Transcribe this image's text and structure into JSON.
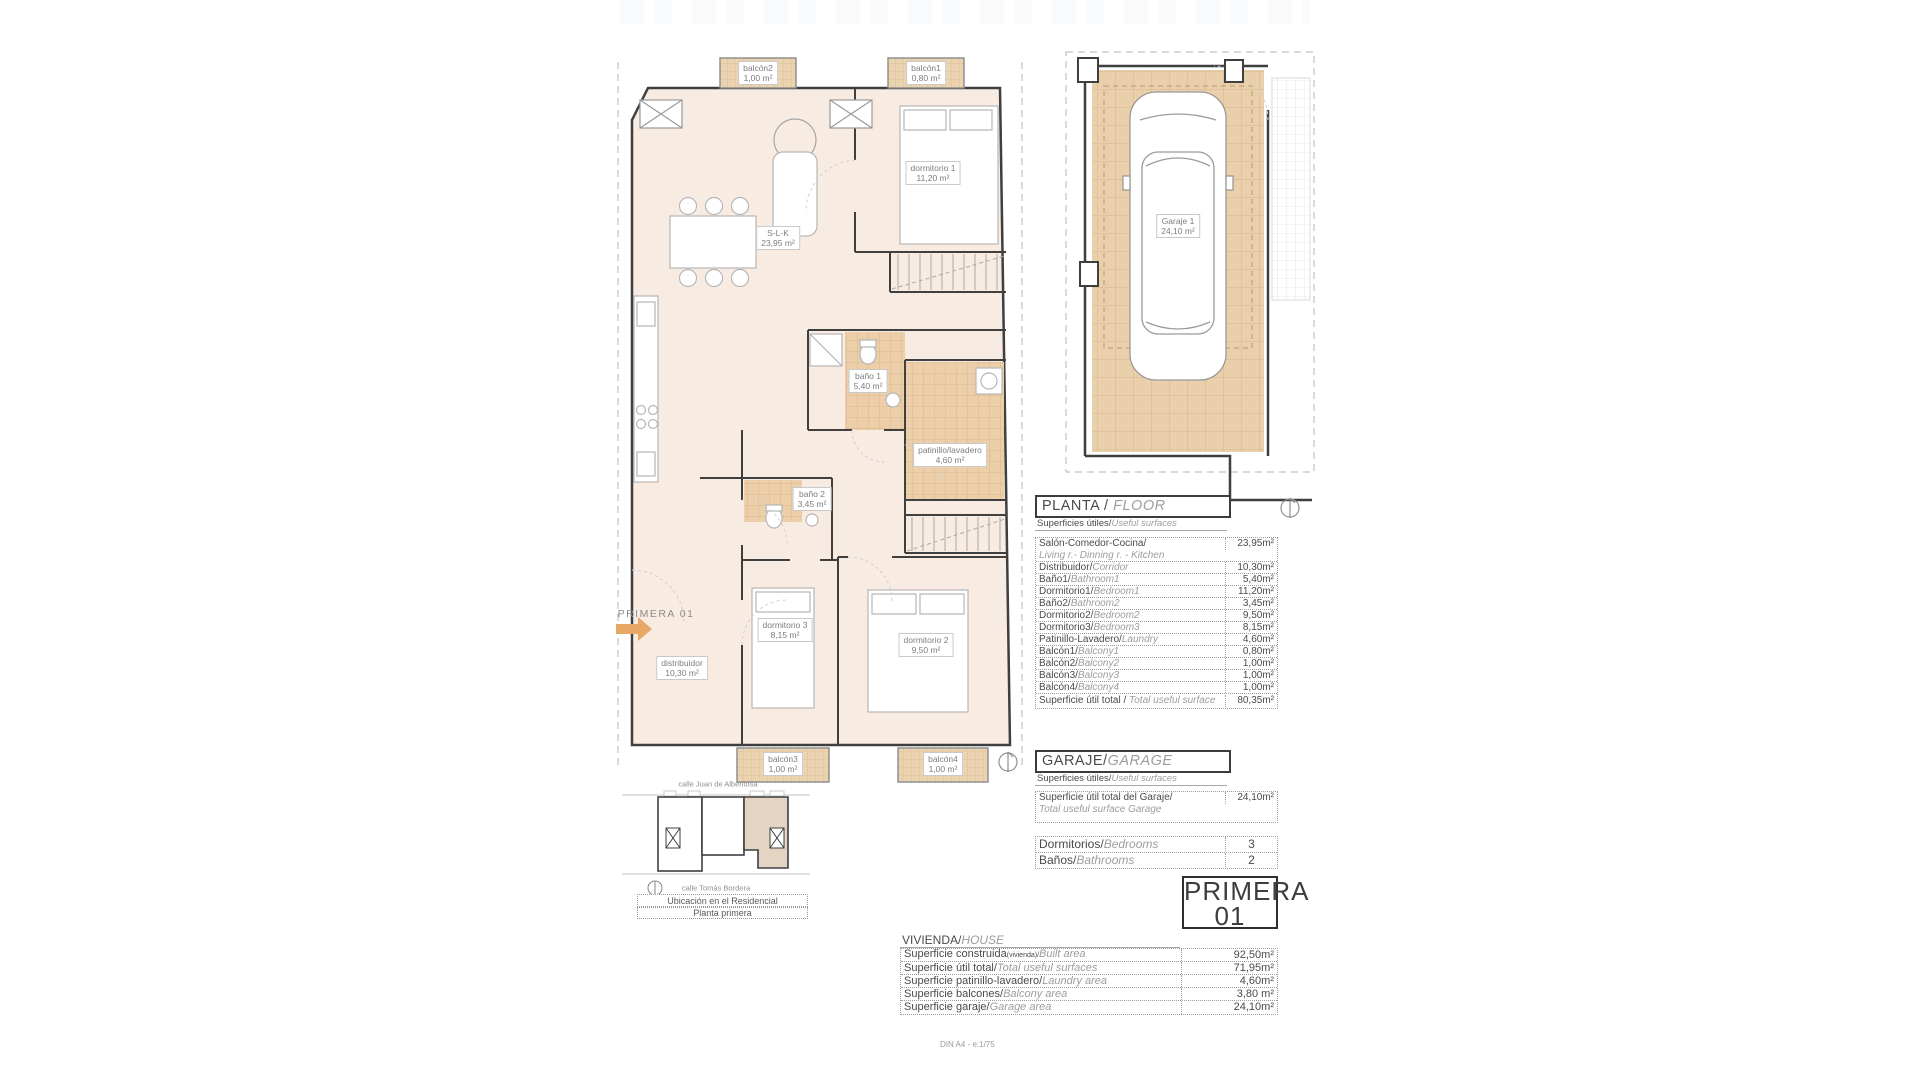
{
  "plan": {
    "unit_label": "PRIMERA 01",
    "labels": [
      {
        "name": "balcón2",
        "area": "1,00 m²"
      },
      {
        "name": "balcón1",
        "area": "0,80 m²"
      },
      {
        "name": "dormitorio 1",
        "area": "11,20 m²"
      },
      {
        "name": "S-L-K",
        "area": "23,95 m²"
      },
      {
        "name": "baño 1",
        "area": "5,40 m²"
      },
      {
        "name": "patinillo/lavadero",
        "area": "4,60 m²"
      },
      {
        "name": "baño 2",
        "area": "3,45 m²"
      },
      {
        "name": "dormitorio 3",
        "area": "8,15 m²"
      },
      {
        "name": "dormitorio 2",
        "area": "9,50 m²"
      },
      {
        "name": "distribuidor",
        "area": "10,30 m²"
      },
      {
        "name": "balcón3",
        "area": "1,00 m²"
      },
      {
        "name": "balcón4",
        "area": "1,00 m²"
      },
      {
        "name": "Garaje 1",
        "area": "24,10 m²"
      }
    ]
  },
  "planta": {
    "title_es": "PLANTA / ",
    "title_en": "FLOOR",
    "subtitle_es": "Superficies útiles/",
    "subtitle_en": "Useful surfaces",
    "rows": [
      {
        "es": "Salón-Comedor-Cocina/",
        "en": "Living r.- Dinning r. - Kitchen",
        "value": "23,95m²"
      },
      {
        "es": "Distribuidor/",
        "en": "Corridor",
        "value": "10,30m²"
      },
      {
        "es": "Baño1/",
        "en": "Bathroom1",
        "value": "5,40m²"
      },
      {
        "es": "Dormitorio1/",
        "en": "Bedroom1",
        "value": "11,20m²"
      },
      {
        "es": "Baño2/",
        "en": "Bathroom2",
        "value": "3,45m²"
      },
      {
        "es": "Dormitorio2/",
        "en": "Bedroom2",
        "value": "9,50m²"
      },
      {
        "es": "Dormitorio3/",
        "en": "Bedroom3",
        "value": "8,15m²"
      },
      {
        "es": "Patinillo-Lavadero/",
        "en": "Laundry",
        "value": "4,60m²"
      },
      {
        "es": "Balcón1/",
        "en": "Balcony1",
        "value": "0,80m²"
      },
      {
        "es": "Balcón2/",
        "en": "Balcony2",
        "value": "1,00m²"
      },
      {
        "es": "Balcón3/",
        "en": "Balcony3",
        "value": "1,00m²"
      },
      {
        "es": "Balcón4/",
        "en": "Balcony4",
        "value": "1,00m²"
      }
    ],
    "total_es": "Superficie útil total / ",
    "total_en": "Total useful surface",
    "total_value": "80,35m²"
  },
  "garaje": {
    "title_es": "GARAJE/",
    "title_en": "GARAGE",
    "subtitle_es": "Superficies útiles/",
    "subtitle_en": "Useful surfaces",
    "row_es": "Superficie útil total del Garaje/",
    "row_en": "Total useful surface Garage",
    "value": "24,10m²"
  },
  "counts": {
    "bedrooms_es": "Dormitorios/",
    "bedrooms_en": "Bedrooms",
    "bedrooms_value": "3",
    "bathrooms_es": "Baños/",
    "bathrooms_en": "Bathrooms",
    "bathrooms_value": "2"
  },
  "unit": {
    "line1": "PRIMERA",
    "line2": "01"
  },
  "vivienda": {
    "title_es": "VIVIENDA/",
    "title_en": "HOUSE",
    "rows": [
      {
        "es": "Superficie construida",
        "tiny": "(vivienda)/",
        "en": "Built area",
        "value": "92,50m²"
      },
      {
        "es": "Superficie útil total/",
        "tiny": "",
        "en": "Total useful surfaces",
        "value": "71,95m²"
      },
      {
        "es": "Superficie patinillo-lavadero/",
        "tiny": "",
        "en": "Laundry area",
        "value": "4,60m²"
      },
      {
        "es": "Superficie balcones/",
        "tiny": "",
        "en": "Balcony area",
        "value": "3,80 m²"
      },
      {
        "es": "Superficie garaje/",
        "tiny": "",
        "en": "Garage area",
        "value": "24,10m²"
      }
    ]
  },
  "minimap": {
    "street_top": "calle Juan de Albentosa",
    "street_bottom": "calle Tomás Bordera",
    "caption1": "Ubicación en el Residencial",
    "caption2": "Planta primera"
  },
  "footer": "DIN A4 - e:1/75",
  "colors": {
    "accent_arrow": "#e7a765",
    "tile": "#eccfa9",
    "floor": "#f8ebe2",
    "wall": "#3f3f3f"
  }
}
